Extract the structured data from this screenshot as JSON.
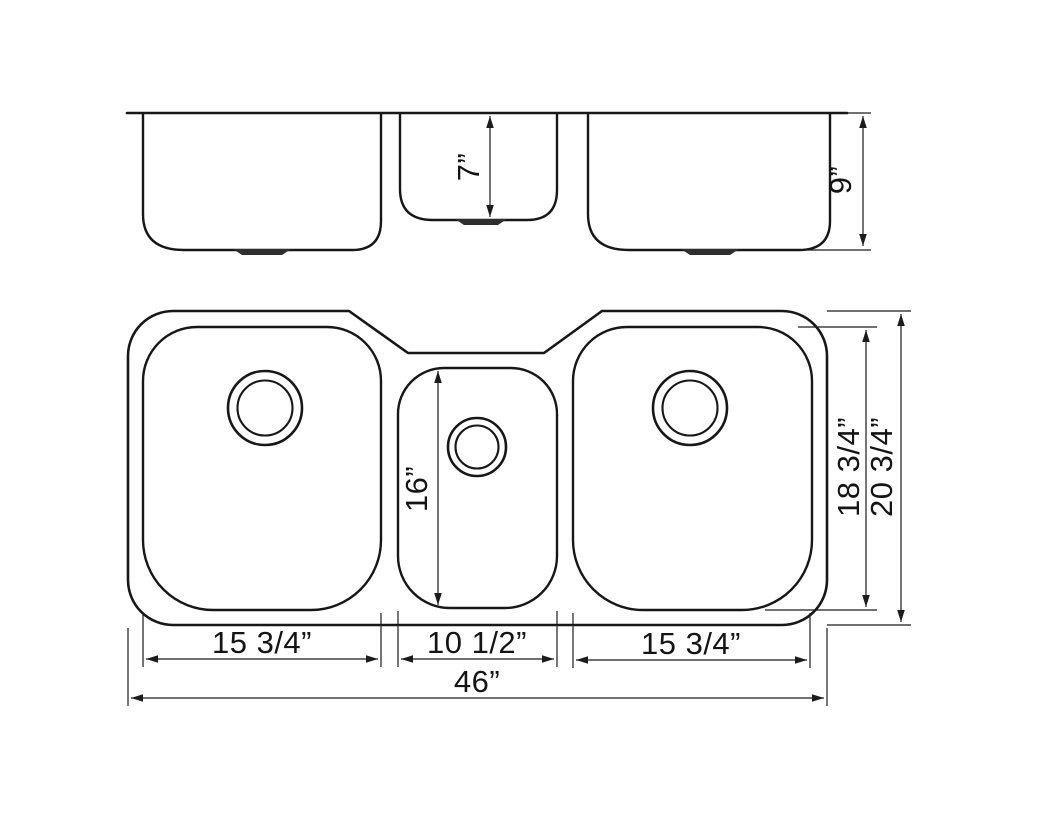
{
  "diagram": {
    "type": "triple-bowl-sink-technical-drawing",
    "colors": {
      "line": "#171717",
      "background": "#ffffff"
    },
    "dims": {
      "front": {
        "middle_bowl_depth": "7”",
        "bowl_depth": "9”"
      },
      "plan": {
        "middle_bowl_length": "16”",
        "side_bowl_length": "18 3/4”",
        "overall_front_to_back": "20 3/4”",
        "left_bowl_width": "15 3/4”",
        "middle_bowl_width": "10 1/2”",
        "right_bowl_width": "15 3/4”",
        "overall_width": "46”"
      }
    }
  }
}
